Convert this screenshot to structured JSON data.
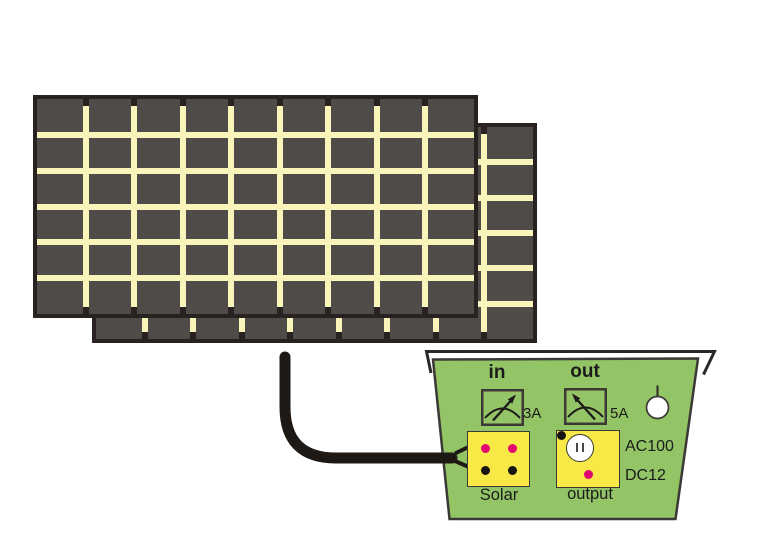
{
  "colors": {
    "panel_cell": "#4f4b49",
    "panel_grid": "#f9f4ba",
    "panel_frame": "#282220",
    "cable": "#1e1915",
    "body_green": "#93c566",
    "outline": "#3c3835",
    "box_yellow": "#f8e947",
    "dot_pink": "#e2066f",
    "dot_black": "#171411"
  },
  "solar_panels": {
    "count": 2,
    "columns": 9,
    "rows": 6
  },
  "cable": {
    "icon": "cable-icon",
    "from": "solar-panel",
    "to": "controller-solar-input"
  },
  "controller": {
    "icon": "charge-controller-icon",
    "meters": {
      "in": {
        "label": "in",
        "value": "3A",
        "icon": "analog-meter-icon",
        "needle": "up-right"
      },
      "out": {
        "label": "out",
        "value": "5A",
        "icon": "analog-meter-icon",
        "needle": "up-left"
      }
    },
    "knob": {
      "icon": "knob-icon"
    },
    "solar_input": {
      "label": "Solar",
      "terminals": [
        "pink",
        "pink",
        "black",
        "black"
      ]
    },
    "output": {
      "label": "output",
      "ac": {
        "label": "AC100",
        "icon": "ac-outlet-icon"
      },
      "dc": {
        "label": "DC12",
        "terminals": [
          "pink",
          "black"
        ]
      }
    }
  }
}
